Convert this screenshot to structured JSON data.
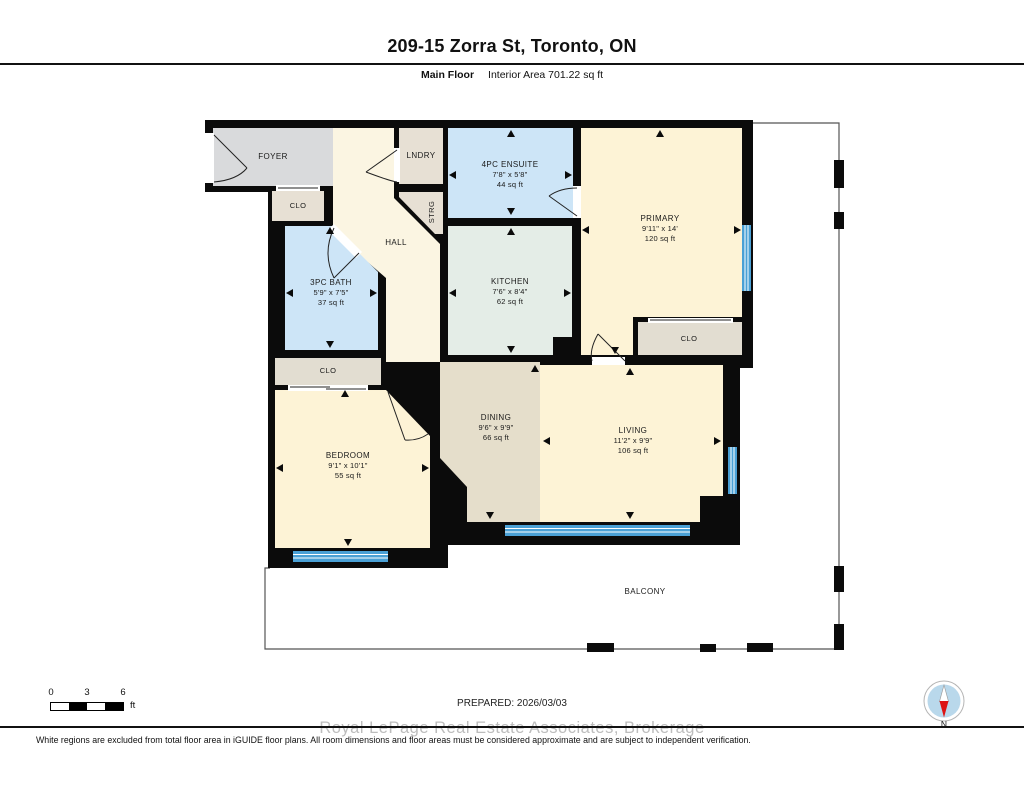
{
  "header": {
    "title": "209-15 Zorra St, Toronto, ON",
    "floor_label": "Main Floor",
    "area_label": "Interior Area 701.22 sq ft"
  },
  "rooms": {
    "foyer": {
      "name": "FOYER"
    },
    "clo_foyer": {
      "name": "CLO"
    },
    "lndry": {
      "name": "LNDRY"
    },
    "strg": {
      "name": "STRG"
    },
    "hall": {
      "name": "HALL"
    },
    "ensuite": {
      "name": "4PC ENSUITE",
      "dims": "7'8\" x 5'8\"",
      "area": "44 sq ft"
    },
    "primary": {
      "name": "PRIMARY",
      "dims": "9'11\" x 14'",
      "area": "120 sq ft"
    },
    "bath": {
      "name": "3PC BATH",
      "dims": "5'9\" x 7'5\"",
      "area": "37 sq ft"
    },
    "kitchen": {
      "name": "KITCHEN",
      "dims": "7'6\" x 8'4\"",
      "area": "62 sq ft"
    },
    "clo_primary": {
      "name": "CLO"
    },
    "clo_bedroom": {
      "name": "CLO"
    },
    "bedroom": {
      "name": "BEDROOM",
      "dims": "9'1\" x 10'1\"",
      "area": "55 sq ft"
    },
    "dining": {
      "name": "DINING",
      "dims": "9'6\" x 9'9\"",
      "area": "66 sq ft"
    },
    "living": {
      "name": "LIVING",
      "dims": "11'2\" x 9'9\"",
      "area": "106 sq ft"
    },
    "balcony": {
      "name": "BALCONY"
    }
  },
  "footer": {
    "scale": {
      "t0": "0",
      "t3": "3",
      "t6": "6",
      "unit": "ft"
    },
    "prepared": "PREPARED: 2026/03/03",
    "watermark": "Royal LePage Real Estate Associates, Brokerage",
    "disclaimer": "White regions are excluded from total floor area in iGUIDE floor plans. All room dimensions and floor areas must be considered approximate and are subject to independent verification.",
    "compass_label": "N"
  },
  "colors": {
    "wall": "#0b0b0b",
    "window_blue": "#4aa0d5",
    "room_cream": "#fdf3d6",
    "room_hall_cream": "#fbf5e2",
    "room_gray": "#d9dadc",
    "room_beige_closet": "#e7e0d4",
    "room_blue_bath": "#cde5f7",
    "room_green_kitchen": "#e4ede7",
    "room_tan_dining": "#e5decb",
    "compass_disc": "#b9d8eb",
    "compass_needle_red": "#dd1414"
  }
}
